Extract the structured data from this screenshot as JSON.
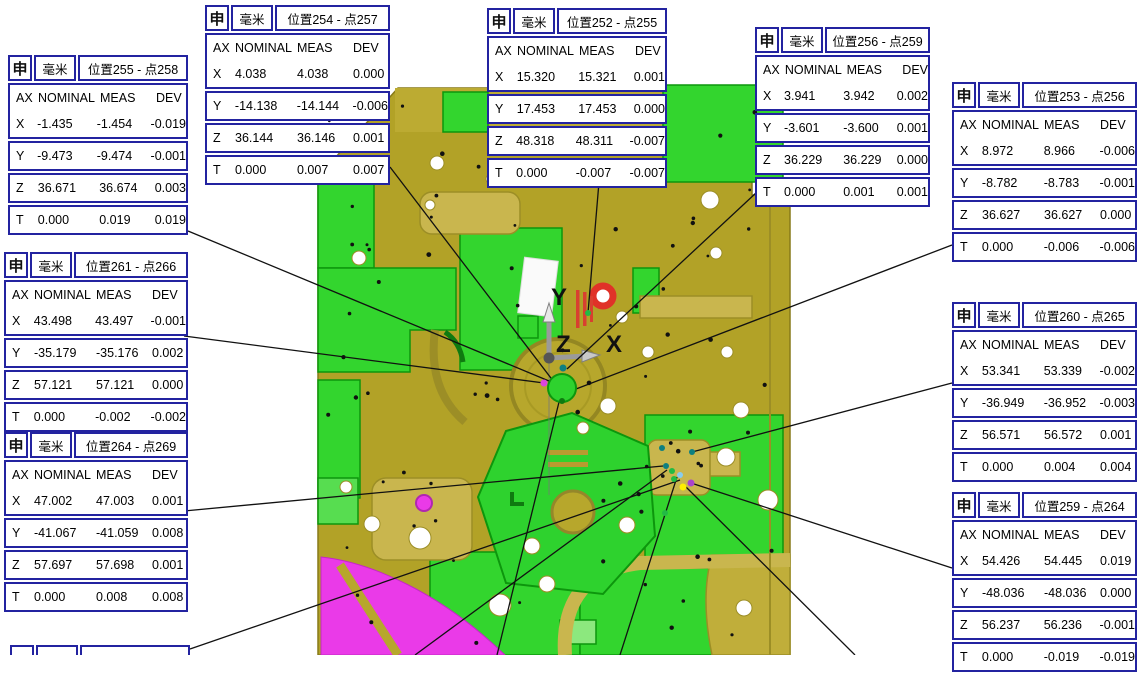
{
  "callout_common": {
    "icon": "申",
    "icon_name": "position-dimension-icon",
    "unit": "毫米"
  },
  "table_columns": [
    "AX",
    "NOMINAL",
    "MEAS",
    "DEV"
  ],
  "callouts": [
    {
      "id": "pos254",
      "title": "位置254 - 点257",
      "rows": [
        [
          "X",
          "4.038",
          "4.038",
          "0.000"
        ],
        [
          "Y",
          "-14.138",
          "-14.144",
          "-0.006"
        ],
        [
          "Z",
          "36.144",
          "36.146",
          "0.001"
        ],
        [
          "T",
          "0.000",
          "0.007",
          "0.007"
        ]
      ]
    },
    {
      "id": "pos252",
      "title": "位置252 - 点255",
      "rows": [
        [
          "X",
          "15.320",
          "15.321",
          "0.001"
        ],
        [
          "Y",
          "17.453",
          "17.453",
          "0.000"
        ],
        [
          "Z",
          "48.318",
          "48.311",
          "-0.007"
        ],
        [
          "T",
          "0.000",
          "-0.007",
          "-0.007"
        ]
      ]
    },
    {
      "id": "pos256",
      "title": "位置256 - 点259",
      "rows": [
        [
          "X",
          "3.941",
          "3.942",
          "0.002"
        ],
        [
          "Y",
          "-3.601",
          "-3.600",
          "0.001"
        ],
        [
          "Z",
          "36.229",
          "36.229",
          "0.000"
        ],
        [
          "T",
          "0.000",
          "0.001",
          "0.001"
        ]
      ]
    },
    {
      "id": "pos255",
      "title": "位置255 - 点258",
      "rows": [
        [
          "X",
          "-1.435",
          "-1.454",
          "-0.019"
        ],
        [
          "Y",
          "-9.473",
          "-9.474",
          "-0.001"
        ],
        [
          "Z",
          "36.671",
          "36.674",
          "0.003"
        ],
        [
          "T",
          "0.000",
          "0.019",
          "0.019"
        ]
      ]
    },
    {
      "id": "pos253",
      "title": "位置253 - 点256",
      "rows": [
        [
          "X",
          "8.972",
          "8.966",
          "-0.006"
        ],
        [
          "Y",
          "-8.782",
          "-8.783",
          "-0.001"
        ],
        [
          "Z",
          "36.627",
          "36.627",
          "0.000"
        ],
        [
          "T",
          "0.000",
          "-0.006",
          "-0.006"
        ]
      ]
    },
    {
      "id": "pos261",
      "title": "位置261 - 点266",
      "rows": [
        [
          "X",
          "43.498",
          "43.497",
          "-0.001"
        ],
        [
          "Y",
          "-35.179",
          "-35.176",
          "0.002"
        ],
        [
          "Z",
          "57.121",
          "57.121",
          "0.000"
        ],
        [
          "T",
          "0.000",
          "-0.002",
          "-0.002"
        ]
      ]
    },
    {
      "id": "pos260",
      "title": "位置260 - 点265",
      "rows": [
        [
          "X",
          "53.341",
          "53.339",
          "-0.002"
        ],
        [
          "Y",
          "-36.949",
          "-36.952",
          "-0.003"
        ],
        [
          "Z",
          "56.571",
          "56.572",
          "0.001"
        ],
        [
          "T",
          "0.000",
          "0.004",
          "0.004"
        ]
      ]
    },
    {
      "id": "pos264",
      "title": "位置264 - 点269",
      "rows": [
        [
          "X",
          "47.002",
          "47.003",
          "0.001"
        ],
        [
          "Y",
          "-41.067",
          "-41.059",
          "0.008"
        ],
        [
          "Z",
          "57.697",
          "57.698",
          "0.001"
        ],
        [
          "T",
          "0.000",
          "0.008",
          "0.008"
        ]
      ]
    },
    {
      "id": "pos259",
      "title": "位置259 - 点264",
      "rows": [
        [
          "X",
          "54.426",
          "54.445",
          "0.019"
        ],
        [
          "Y",
          "-48.036",
          "-48.036",
          "0.000"
        ],
        [
          "Z",
          "56.237",
          "56.236",
          "-0.001"
        ],
        [
          "T",
          "0.000",
          "-0.019",
          "-0.019"
        ]
      ]
    }
  ],
  "viewport": {
    "axis_labels": {
      "x": "X",
      "y": "Y",
      "z": "Z"
    },
    "colors": {
      "model_base": "#b2a227",
      "model_tan": "#c9b64e",
      "model_green": "#33d52e",
      "model_dark_green": "#0d960d",
      "model_magenta": "#ea3ae8",
      "marker_red": "#e03228",
      "box_border": "#2323a0"
    }
  }
}
